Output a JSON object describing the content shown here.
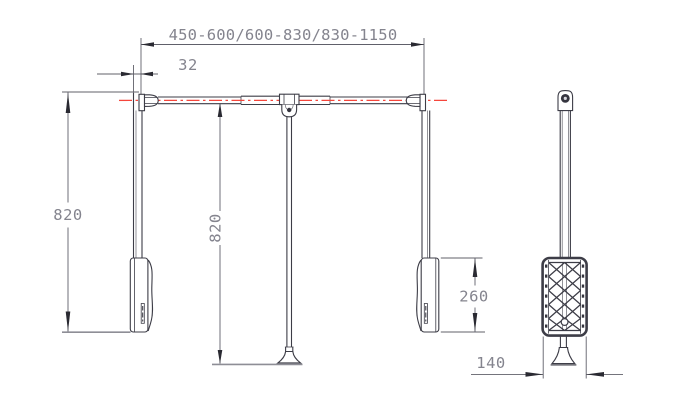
{
  "drawing": {
    "type": "technical-drawing",
    "subject": "pull-down wardrobe lift, front and side views"
  },
  "colors": {
    "bg": "#ffffff",
    "ink": "#3d3d47",
    "dim": "#60606a",
    "arrow": "#2a2a32",
    "text": "#84848e",
    "red": "#f5463c",
    "ground": "#8e8e96"
  },
  "labels": {
    "width_range": "450-600/600-830/830-1150",
    "offset": "32",
    "arm_height": "820",
    "pole_height": "820",
    "bracket_height": "260",
    "side_depth": "140"
  }
}
